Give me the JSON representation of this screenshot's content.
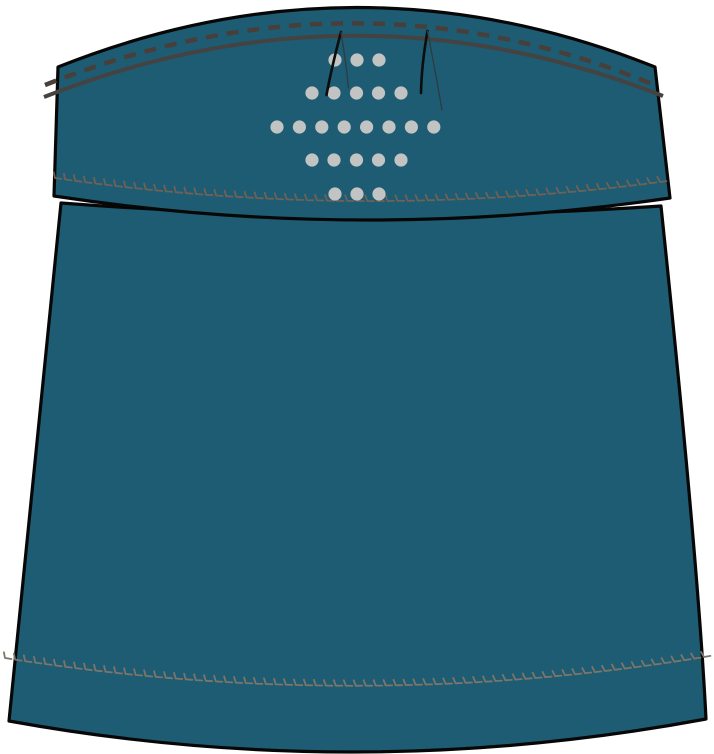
{
  "illustration": {
    "kind": "garment-flat-sketch",
    "subject": "teal-skort-front",
    "canvas": {
      "width": 714,
      "height": 754
    }
  },
  "colors": {
    "background": "#ffffff",
    "fabric_teal": "#1d5c72",
    "outline_black": "#070707",
    "dashed_stitch": "#483f3a",
    "solid_stitch": "#454242",
    "yoke_overlock": "#6e6257",
    "hem_overlock": "#7d7569",
    "perforation_dot": "#c2c4c4",
    "dart_heavy": "#0d0d0d",
    "dart_light": "#2e3b42"
  },
  "parts": {
    "skirt_body": {
      "path": "M 61 203 Q 361 226 661 206 Q 698 560 706 719 Q 357 784 9 721 Q 24 560 61 203 Z",
      "stroke_width": 3.2
    },
    "yoke": {
      "path": "M 58 67 Q 357 -52 655 67 L 670 198 Q 362 243 54 196 Z",
      "stroke_width": 3.2
    },
    "dashed_topstitch": {
      "path": "M 45 85 Q 355 -38 652 84",
      "stroke_width": 4.5,
      "dash": [
        12,
        9
      ]
    },
    "solid_topstitch": {
      "path": "M 44 97 Q 355 -25 663 96",
      "stroke_width": 4
    },
    "yoke_overlock": {
      "p0": [
        55,
        178
      ],
      "c": [
        357,
        222
      ],
      "p1": [
        660,
        182
      ],
      "step": 10,
      "tick": 5.5,
      "slant": 2,
      "foot": 6.5,
      "stroke_width": 1.8
    },
    "hem_overlock": {
      "p0": [
        5,
        658
      ],
      "c": [
        357,
        714
      ],
      "p1": [
        704,
        657
      ],
      "step": 10,
      "tick": 5.5,
      "slant": 2,
      "foot": 6.5,
      "stroke_width": 1.8
    },
    "perforation_dots": {
      "radius": 6.6,
      "rows": [
        {
          "y": 60,
          "xs": [
            335,
            357,
            379
          ]
        },
        {
          "y": 93,
          "xs": [
            312,
            334,
            356.5,
            378.5,
            401
          ]
        },
        {
          "y": 127,
          "xs": [
            277,
            299.4,
            321.8,
            344.2,
            366.6,
            389,
            411.4,
            433.8
          ]
        },
        {
          "y": 160,
          "xs": [
            312,
            334,
            356.5,
            378.5,
            401
          ]
        },
        {
          "y": 194,
          "xs": [
            335,
            357,
            379
          ]
        }
      ]
    },
    "darts": [
      {
        "name": "left-dart",
        "heavy_leg": {
          "d": "M 341 32 Q 331 70 326.5 95",
          "width": 2.6
        },
        "light_leg": {
          "d": "M 341 32 Q 346 62 348.5 88",
          "width": 1.3
        }
      },
      {
        "name": "right-dart",
        "heavy_leg": {
          "d": "M 427.5 31 Q 421.5 65 421 93",
          "width": 2.6
        },
        "light_leg": {
          "d": "M 427.5 31 Q 436 75 442 110",
          "width": 1.3
        }
      }
    ]
  }
}
